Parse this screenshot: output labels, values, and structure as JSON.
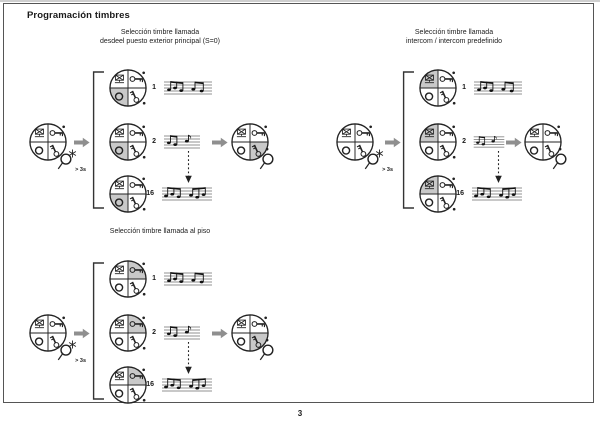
{
  "page": {
    "title": "Programación timbres",
    "page_number": "3"
  },
  "colors": {
    "highlight_shade": "#c9c9c9",
    "arrow_gray": "#8f8f8f",
    "line": "#222222",
    "frame_border": "#555555"
  },
  "icons": {
    "entrance_panel": "entrance-panel-icon",
    "door_key_horizontal": "door-key-icon",
    "aux_round_button": "round-button-icon",
    "door_key_vertical": "key-2-icon",
    "finger_press": "finger-press-icon",
    "star": "star-icon",
    "music_notes": "music-notes-icon",
    "block_arrow": "arrow-right-icon",
    "dotted_arrow": "dotted-arrow-down-icon"
  },
  "groups": [
    {
      "heading_line1": "Selección timbre llamada",
      "heading_line2": "desdeel puesto exterior principal (S=0)",
      "hold_label": "> 3s",
      "shaded_quadrant": "bl",
      "final_shaded_quadrant": "br",
      "tones": [
        {
          "num": "1"
        },
        {
          "num": "2"
        },
        {
          "num": "16"
        }
      ]
    },
    {
      "heading_line1": "Selección timbre llamada",
      "heading_line2": "intercom / intercom predefinido",
      "hold_label": "> 3s",
      "shaded_quadrant": "tl",
      "final_shaded_quadrant": "",
      "tones": [
        {
          "num": "1"
        },
        {
          "num": "2"
        },
        {
          "num": "16"
        }
      ]
    },
    {
      "heading_line1": "Selección timbre llamada al piso",
      "heading_line2": "",
      "hold_label": "> 3s",
      "shaded_quadrant": "tr",
      "final_shaded_quadrant": "br",
      "tones": [
        {
          "num": "1"
        },
        {
          "num": "2"
        },
        {
          "num": "16"
        }
      ]
    }
  ]
}
